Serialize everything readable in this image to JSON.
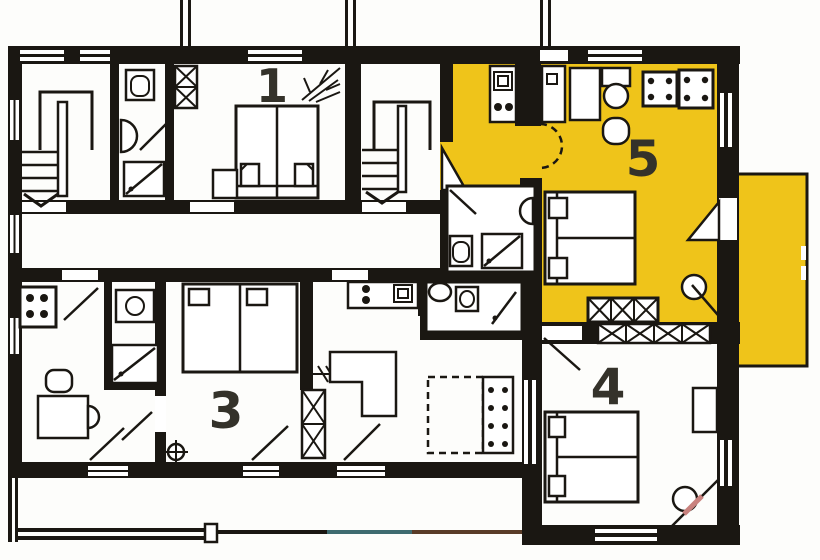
{
  "floorplan": {
    "title": "Apartment floor plan",
    "highlighted_apartment": "5",
    "room_labels": {
      "r1": "1",
      "r3": "3",
      "r4": "4",
      "r5": "5"
    },
    "colors": {
      "wall": "#1a1712",
      "background": "#fdfdfb",
      "highlight": "#efc41a",
      "label": "#34322a",
      "door_accent": "#c9827e",
      "railing_teal": "#3e6b70",
      "railing_brown": "#5a3c28"
    }
  }
}
